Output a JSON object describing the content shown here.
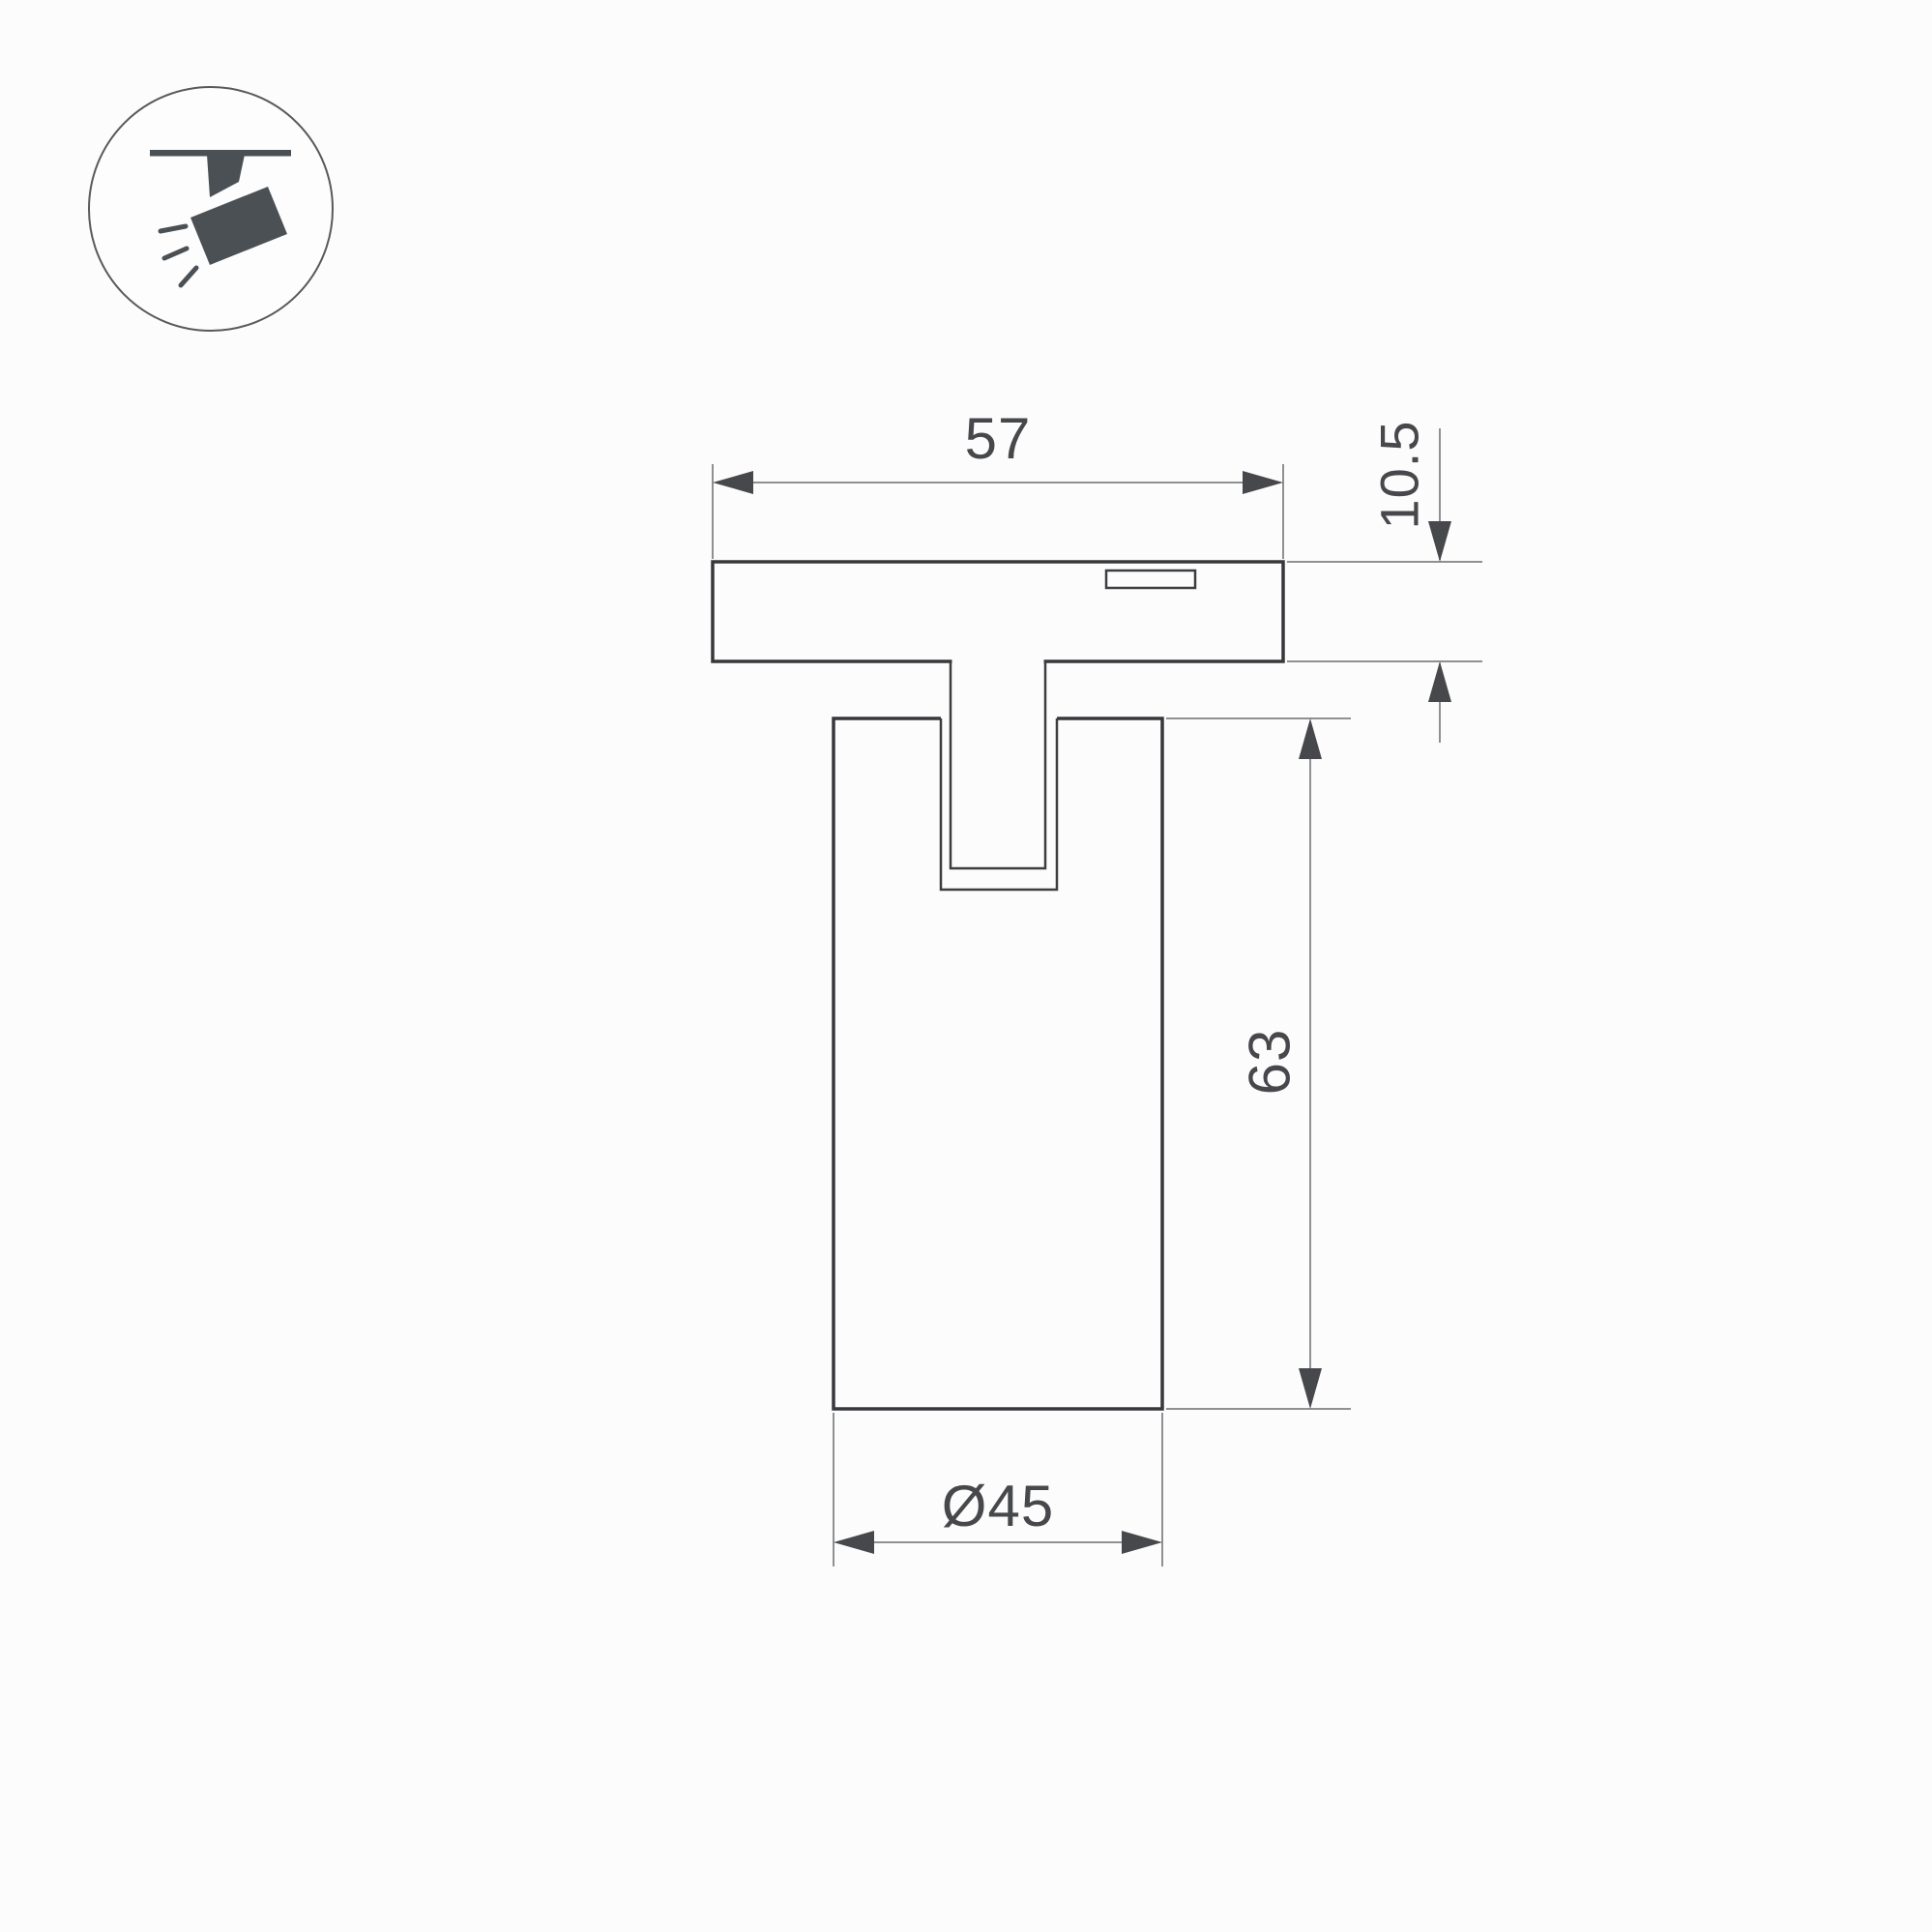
{
  "page": {
    "background_color": "#fcfcfc",
    "content_type": "product technical dimension drawing"
  },
  "icon_badge": {
    "name": "track-spotlight-pictogram",
    "description": "circled pictogram of a spotlight hanging from a ceiling track with light rays",
    "glyph_color": "#4b5055",
    "circle_stroke_color": "#58595c"
  },
  "drawing": {
    "view": "front elevation of track-mounted cylindrical spotlight",
    "colors": {
      "outline": "#37383b",
      "dimension_lines": "#8f9092",
      "arrows_and_text": "#47484b"
    },
    "dimensions": {
      "track_width": {
        "label": "57"
      },
      "base_height": {
        "label": "10.5"
      },
      "body_height": {
        "label": "63"
      },
      "body_diameter": {
        "label": "Ø45"
      }
    }
  }
}
